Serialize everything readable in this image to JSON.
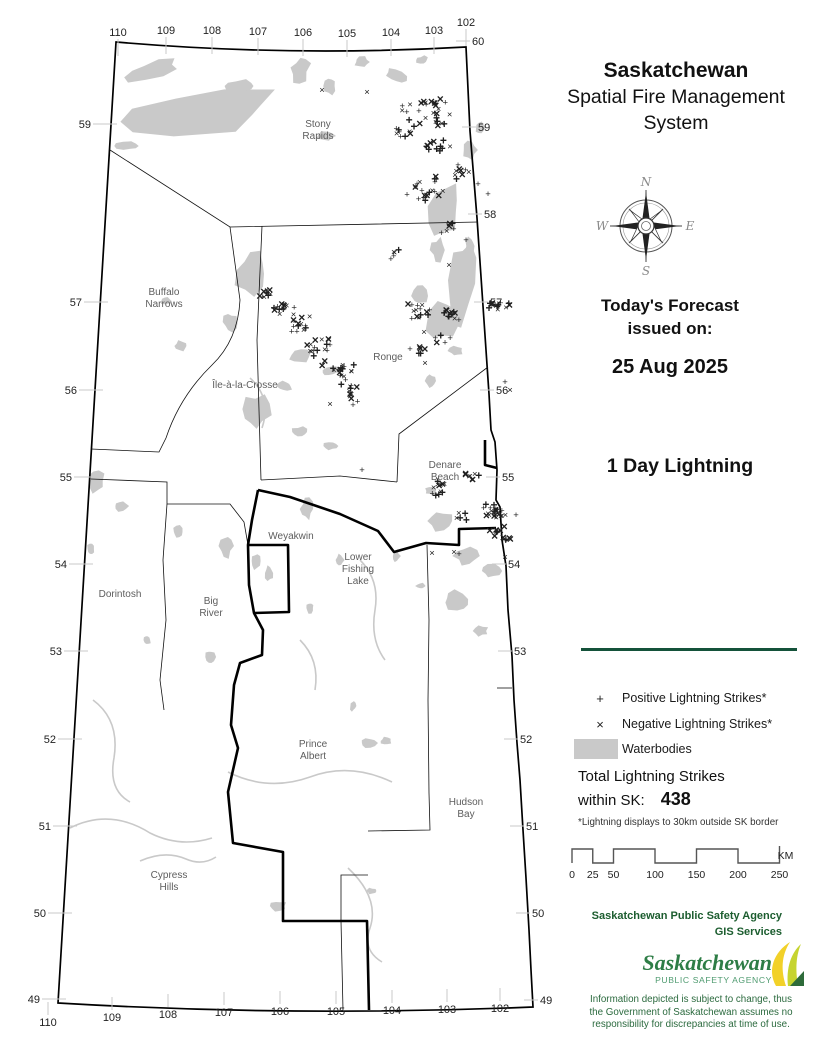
{
  "header": {
    "title": "Saskatchewan",
    "subtitle": "Spatial Fire Management System"
  },
  "forecast": {
    "line1": "Today's Forecast",
    "line2": "issued on:",
    "date": "25 Aug 2025"
  },
  "product_title": "1 Day Lightning",
  "compass": {
    "n": "N",
    "e": "E",
    "s": "S",
    "w": "W"
  },
  "legend": {
    "items": [
      {
        "symbol": "+",
        "label": "Positive Lightning Strikes*"
      },
      {
        "symbol": "×",
        "label": "Negative Lightning Strikes*"
      },
      {
        "symbol": "swatch",
        "label": "Waterbodies"
      }
    ],
    "total_line1": "Total Lightning Strikes",
    "total_line2": "within SK:",
    "total_value": "438",
    "footnote": "*Lightning displays to 30km outside SK border"
  },
  "scalebar": {
    "ticks": [
      0,
      25,
      50,
      100,
      150,
      200,
      250
    ],
    "unit": "KM"
  },
  "agency": {
    "line1": "Saskatchewan Public Safety Agency",
    "line2": "GIS  Services",
    "logo_main": "Saskatchewan",
    "logo_sub": "PUBLIC SAFETY AGENCY",
    "disclaimer": [
      "Information depicted is subject to change, thus",
      "the Government of Saskatchewan assumes no",
      "responsibility for discrepancies at time of use."
    ]
  },
  "colors": {
    "accent_green": "#14523a",
    "text_green": "#1c5d2f",
    "logo_green": "#2e7d46",
    "logo_sub_green": "#4f9b70",
    "waterbody_gray": "#c9c9c9"
  },
  "map": {
    "graticule": {
      "top": [
        {
          "t": "110",
          "x": 118,
          "y": 36
        },
        {
          "t": "109",
          "x": 166,
          "y": 34
        },
        {
          "t": "108",
          "x": 212,
          "y": 34
        },
        {
          "t": "107",
          "x": 258,
          "y": 35
        },
        {
          "t": "106",
          "x": 303,
          "y": 36
        },
        {
          "t": "105",
          "x": 347,
          "y": 37
        },
        {
          "t": "104",
          "x": 391,
          "y": 36
        },
        {
          "t": "103",
          "x": 434,
          "y": 34
        },
        {
          "t": "102",
          "x": 466,
          "y": 26
        }
      ],
      "bottom": [
        {
          "t": "110",
          "x": 48,
          "y": 1026
        },
        {
          "t": "109",
          "x": 112,
          "y": 1021
        },
        {
          "t": "108",
          "x": 168,
          "y": 1018
        },
        {
          "t": "107",
          "x": 224,
          "y": 1016
        },
        {
          "t": "106",
          "x": 280,
          "y": 1015
        },
        {
          "t": "105",
          "x": 336,
          "y": 1015
        },
        {
          "t": "104",
          "x": 392,
          "y": 1014
        },
        {
          "t": "103",
          "x": 447,
          "y": 1013
        },
        {
          "t": "102",
          "x": 500,
          "y": 1012
        }
      ],
      "left": [
        {
          "t": "59",
          "x": 91,
          "y": 128
        },
        {
          "t": "57",
          "x": 82,
          "y": 306
        },
        {
          "t": "56",
          "x": 77,
          "y": 394
        },
        {
          "t": "55",
          "x": 72,
          "y": 481
        },
        {
          "t": "54",
          "x": 67,
          "y": 568
        },
        {
          "t": "53",
          "x": 62,
          "y": 655
        },
        {
          "t": "52",
          "x": 56,
          "y": 743
        },
        {
          "t": "51",
          "x": 51,
          "y": 830
        },
        {
          "t": "50",
          "x": 46,
          "y": 917
        },
        {
          "t": "49",
          "x": 40,
          "y": 1003
        }
      ],
      "right": [
        {
          "t": "60",
          "x": 472,
          "y": 45
        },
        {
          "t": "59",
          "x": 478,
          "y": 131
        },
        {
          "t": "58",
          "x": 484,
          "y": 218
        },
        {
          "t": "57",
          "x": 490,
          "y": 306
        },
        {
          "t": "56",
          "x": 496,
          "y": 394
        },
        {
          "t": "55",
          "x": 502,
          "y": 481
        },
        {
          "t": "54",
          "x": 508,
          "y": 568
        },
        {
          "t": "53",
          "x": 514,
          "y": 655
        },
        {
          "t": "52",
          "x": 520,
          "y": 743
        },
        {
          "t": "51",
          "x": 526,
          "y": 830
        },
        {
          "t": "50",
          "x": 532,
          "y": 917
        },
        {
          "t": "49",
          "x": 540,
          "y": 1004
        }
      ]
    },
    "places": [
      {
        "lines": [
          "Stony",
          "Rapids"
        ],
        "x": 318,
        "y": 127
      },
      {
        "lines": [
          "Buffalo",
          "Narrows"
        ],
        "x": 164,
        "y": 295
      },
      {
        "lines": [
          "Île-à-la-Crosse"
        ],
        "x": 245,
        "y": 388
      },
      {
        "lines": [
          "Ronge"
        ],
        "x": 388,
        "y": 360
      },
      {
        "lines": [
          "Denare",
          "Beach"
        ],
        "x": 445,
        "y": 468
      },
      {
        "lines": [
          "Weyakwin"
        ],
        "x": 291,
        "y": 539
      },
      {
        "lines": [
          "Lower",
          "Fishing",
          "Lake"
        ],
        "x": 358,
        "y": 560
      },
      {
        "lines": [
          "Dorintosh"
        ],
        "x": 120,
        "y": 597
      },
      {
        "lines": [
          "Big",
          "River"
        ],
        "x": 211,
        "y": 604
      },
      {
        "lines": [
          "Prince",
          "Albert"
        ],
        "x": 313,
        "y": 747
      },
      {
        "lines": [
          "Hudson",
          "Bay"
        ],
        "x": 466,
        "y": 805
      },
      {
        "lines": [
          "Cypress",
          "Hills"
        ],
        "x": 169,
        "y": 878
      }
    ],
    "outline": "M 116,42 Q 290,57 466,47 L 470,131 L 477,218 L 483,306 L 486,350 L 489,394 L 491,430 L 495,442 L 497,470 L 496,500 L 500,507 L 502,540 L 506,566 L 508,610 L 512,656 L 514,700 L 517,743 L 520,780 L 523,830 L 526,878 L 529,930 L 531,970 L 533,1007 Q 295,1017 58,1003 Z",
    "boundaries_thin": [
      "M 110,150 L 230,227 L 478,222",
      "M 230,227 L 240,300 Q 238,340 212,365 Q 180,396 166,438 L 159,452 L 91,449",
      "M 262,226 L 257,340 L 261,480",
      "M 488,367 L 399,434 L 397,482",
      "M 261,480 L 340,476 L 397,482",
      "M 91,479 L 167,482 L 167,504 L 230,504 L 244,522 L 248,545",
      "M 167,504 L 163,560 L 166,620 L 160,680 L 164,710",
      "M 427,545 L 429,620 L 428,700 L 429,793 L 430,830 L 368,831",
      "M 368,875 L 341,875 L 341,921 L 343,1010",
      "M 497,688 L 512,688"
    ],
    "boundaries_thick": [
      "M 258,490 L 290,497 L 340,514 L 378,531 L 394,552 L 426,543 L 459,545 L 459,529 L 496,528",
      "M 258,490 L 252,520 L 248,545 L 288,545 L 289,612 L 254,613 L 249,585 L 248,545",
      "M 254,613 L 263,630 L 262,655 L 240,663 L 234,685 L 231,725 L 238,748 L 228,792 L 233,843 L 283,852 L 283,921 L 367,921 L 369,1010",
      "M 485,440 L 485,465 L 497,468"
    ],
    "rivers": [
      "M 70,828 Q 110,808 150,833 Q 180,848 212,838",
      "M 140,861 Q 165,850 186,859 Q 202,866 216,857",
      "M 228,772 Q 268,792 310,777 Q 350,762 392,782",
      "M 348,868 Q 380,898 370,928 Q 362,950 382,962",
      "M 93,700 Q 120,720 114,758 Q 108,790 130,802",
      "M 250,378 Q 272,398 262,428",
      "M 300,640 Q 320,660 315,690",
      "M 360,560 Q 380,580 375,610 Q 370,640 385,660"
    ],
    "waterbodies": [
      [
        200,
        112,
        85,
        20,
        -7
      ],
      [
        152,
        70,
        26,
        8,
        -15
      ],
      [
        240,
        86,
        16,
        6,
        0
      ],
      [
        127,
        146,
        11,
        4,
        0
      ],
      [
        300,
        70,
        9,
        13,
        15
      ],
      [
        330,
        86,
        6,
        8,
        0
      ],
      [
        362,
        62,
        8,
        5,
        0
      ],
      [
        396,
        76,
        10,
        6,
        25
      ],
      [
        422,
        60,
        6,
        4,
        0
      ],
      [
        325,
        136,
        10,
        4,
        0
      ],
      [
        252,
        272,
        15,
        21,
        8
      ],
      [
        230,
        322,
        7,
        9,
        0
      ],
      [
        181,
        346,
        7,
        5,
        0
      ],
      [
        166,
        301,
        5,
        4,
        0
      ],
      [
        445,
        210,
        14,
        24,
        12
      ],
      [
        462,
        282,
        12,
        38,
        7
      ],
      [
        438,
        250,
        7,
        11,
        0
      ],
      [
        470,
        150,
        7,
        9,
        0
      ],
      [
        480,
        128,
        5,
        6,
        0
      ],
      [
        300,
        356,
        11,
        7,
        -18
      ],
      [
        330,
        371,
        9,
        5,
        -15
      ],
      [
        285,
        386,
        7,
        5,
        0
      ],
      [
        256,
        412,
        13,
        17,
        12
      ],
      [
        300,
        432,
        8,
        5,
        0
      ],
      [
        331,
        446,
        7,
        4,
        0
      ],
      [
        440,
        321,
        16,
        20,
        8
      ],
      [
        420,
        296,
        7,
        9,
        0
      ],
      [
        456,
        351,
        7,
        5,
        0
      ],
      [
        431,
        381,
        5,
        7,
        0
      ],
      [
        470,
        246,
        5,
        8,
        0
      ],
      [
        440,
        521,
        12,
        9,
        0
      ],
      [
        466,
        556,
        11,
        8,
        0
      ],
      [
        431,
        491,
        6,
        4,
        0
      ],
      [
        491,
        571,
        9,
        6,
        0
      ],
      [
        456,
        601,
        13,
        9,
        18
      ],
      [
        481,
        631,
        7,
        5,
        0
      ],
      [
        307,
        509,
        6,
        10,
        0
      ],
      [
        269,
        573,
        4,
        7,
        0
      ],
      [
        396,
        556,
        4,
        6,
        0
      ],
      [
        421,
        586,
        5,
        3,
        0
      ],
      [
        368,
        743,
        8,
        5,
        0
      ],
      [
        386,
        741,
        6,
        4,
        0
      ],
      [
        353,
        706,
        3,
        5,
        0
      ],
      [
        96,
        481,
        9,
        11,
        0
      ],
      [
        121,
        506,
        7,
        5,
        0
      ],
      [
        91,
        549,
        4,
        6,
        0
      ],
      [
        226,
        546,
        7,
        11,
        0
      ],
      [
        256,
        561,
        5,
        8,
        0
      ],
      [
        278,
        906,
        8,
        5,
        0
      ],
      [
        371,
        891,
        5,
        3,
        0
      ],
      [
        210,
        657,
        5,
        7,
        0
      ],
      [
        147,
        640,
        4,
        5,
        0
      ],
      [
        178,
        532,
        5,
        6,
        0
      ],
      [
        310,
        608,
        4,
        5,
        0
      ],
      [
        340,
        560,
        4,
        6,
        0
      ]
    ],
    "strike_clusters": [
      [
        425,
        115,
        20,
        30
      ],
      [
        404,
        136,
        9,
        8
      ],
      [
        437,
        151,
        13,
        11
      ],
      [
        460,
        177,
        9,
        7
      ],
      [
        425,
        196,
        16,
        20
      ],
      [
        448,
        232,
        7,
        6
      ],
      [
        392,
        257,
        6,
        5
      ],
      [
        497,
        308,
        10,
        14
      ],
      [
        266,
        296,
        8,
        9
      ],
      [
        280,
        312,
        6,
        6
      ],
      [
        286,
        309,
        7,
        6
      ],
      [
        303,
        327,
        11,
        14
      ],
      [
        318,
        351,
        13,
        16
      ],
      [
        340,
        374,
        15,
        19
      ],
      [
        349,
        396,
        11,
        11
      ],
      [
        420,
        314,
        13,
        14
      ],
      [
        452,
        320,
        8,
        14
      ],
      [
        443,
        344,
        8,
        6
      ],
      [
        422,
        355,
        7,
        5
      ],
      [
        440,
        492,
        11,
        12
      ],
      [
        472,
        479,
        7,
        8
      ],
      [
        494,
        515,
        9,
        26
      ],
      [
        497,
        535,
        6,
        9
      ],
      [
        460,
        520,
        6,
        5
      ],
      [
        506,
        543,
        5,
        5
      ]
    ],
    "strike_singles": [
      [
        322,
        93,
        "×"
      ],
      [
        367,
        95,
        "×"
      ],
      [
        435,
        116,
        "+"
      ],
      [
        458,
        168,
        "+"
      ],
      [
        455,
        178,
        "×"
      ],
      [
        478,
        187,
        "+"
      ],
      [
        488,
        197,
        "+"
      ],
      [
        466,
        243,
        "+"
      ],
      [
        424,
        335,
        "×"
      ],
      [
        425,
        366,
        "×"
      ],
      [
        330,
        407,
        "×"
      ],
      [
        353,
        408,
        "+"
      ],
      [
        410,
        352,
        "+"
      ],
      [
        362,
        473,
        "+"
      ],
      [
        505,
        385,
        "+"
      ],
      [
        510,
        393,
        "×"
      ],
      [
        454,
        555,
        "×"
      ],
      [
        459,
        557,
        "+"
      ],
      [
        432,
        556,
        "×"
      ],
      [
        516,
        518,
        "+"
      ],
      [
        505,
        560,
        "×"
      ],
      [
        449,
        268,
        "×"
      ]
    ]
  }
}
